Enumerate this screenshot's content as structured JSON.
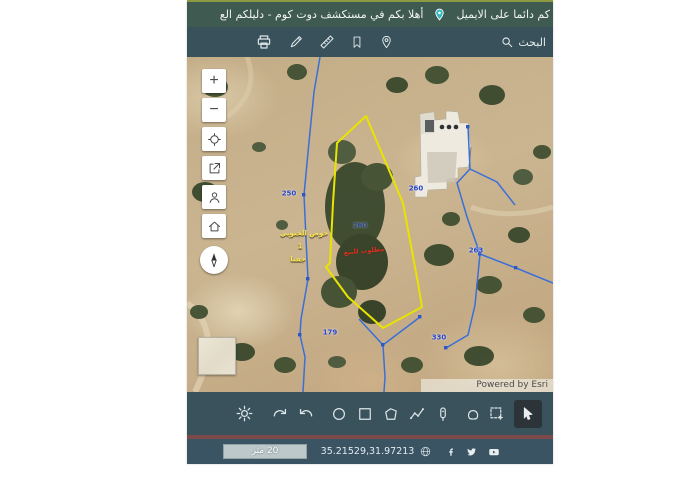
{
  "marquee": {
    "segment_right": "كم دائما على الايميل",
    "segment_left": "أهلا بكم في مستكشف دوت كوم - دليلكم الع",
    "pin_icon": "location-pin-icon"
  },
  "toolbar": {
    "search_label": "البحث",
    "icons": [
      "printer-icon",
      "pencil-icon",
      "ruler-icon",
      "bookmark-icon",
      "location-pin-icon",
      "search-icon"
    ]
  },
  "map": {
    "attribution": "Powered by Esri",
    "zoom_in_label": "+",
    "zoom_out_label": "−",
    "controls": [
      "zoom-in",
      "zoom-out",
      "locate",
      "share",
      "user",
      "home",
      "compass",
      "overview-inset"
    ],
    "parcel_numbers": [
      {
        "text": "250"
      },
      {
        "text": "260"
      },
      {
        "text": "260"
      },
      {
        "text": "263"
      },
      {
        "text": "179"
      },
      {
        "text": "330"
      }
    ],
    "place_labels": [
      {
        "text": "حوض الجنوبي"
      },
      {
        "text": "1"
      },
      {
        "text": "جفنا"
      }
    ],
    "red_label": "مطلوب للبيع",
    "colors": {
      "parcel_highlight": "#e8e400",
      "boundary_blue": "#3a6fd8",
      "number_blue": "#2545cc",
      "label_yellow": "#ffe84a",
      "label_red": "#e0321e"
    }
  },
  "draw_toolbar": {
    "tools": [
      "settings-gear",
      "redo",
      "undo",
      "draw-circle",
      "draw-rectangle",
      "draw-polygon",
      "draw-polyline",
      "draw-marker",
      "draw-freehand",
      "select-area",
      "pointer"
    ],
    "active_tool": "pointer"
  },
  "status_bar": {
    "scale_label": "20 متر",
    "coordinates": "35.21529,31.97213",
    "globe_icon": "globe-icon",
    "social": [
      "facebook-icon",
      "twitter-icon",
      "youtube-icon"
    ]
  }
}
